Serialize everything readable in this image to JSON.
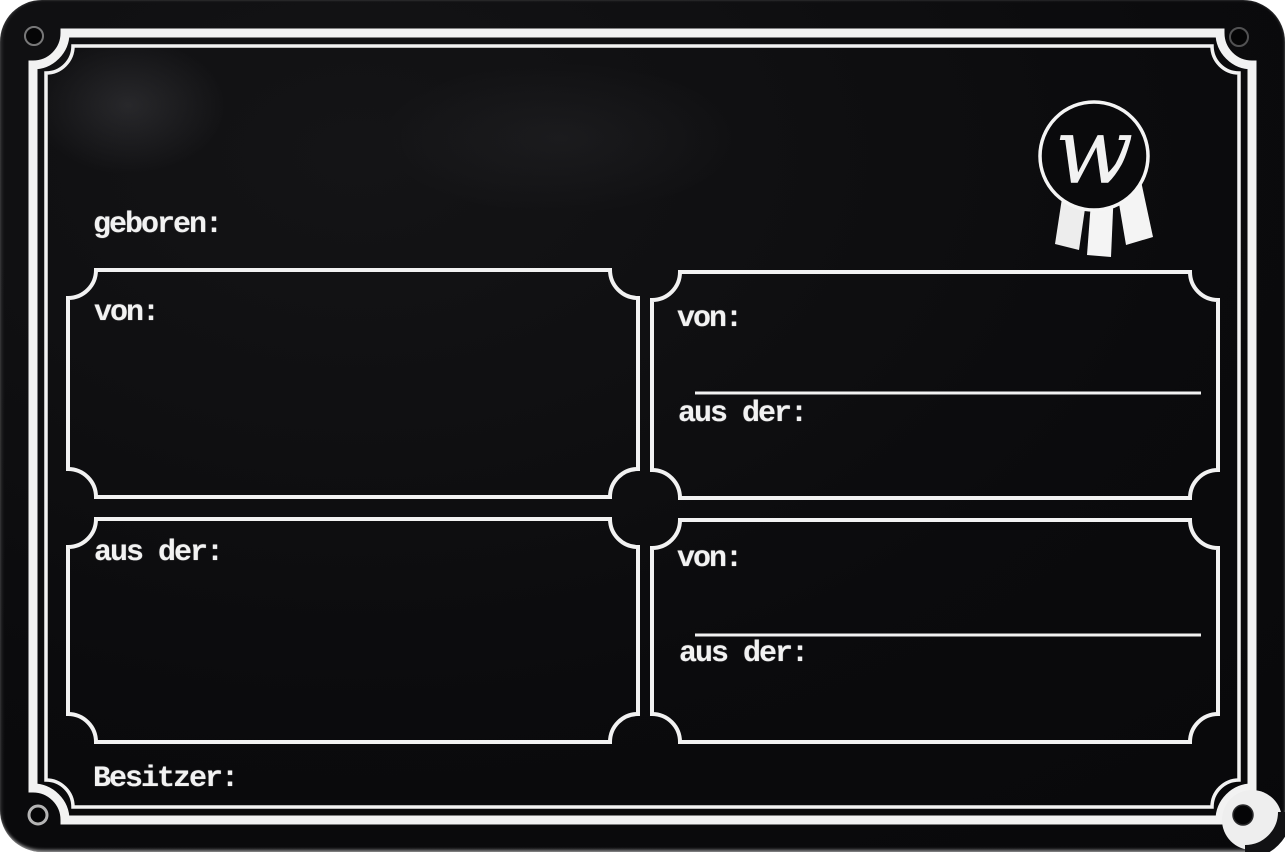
{
  "sign": {
    "born_label": "geboren:",
    "owner_label": "Besitzer:",
    "boxes": {
      "top_left": {
        "sire_label": "von:"
      },
      "top_right": {
        "sire_label": "von:",
        "dam_label": "aus der:"
      },
      "bottom_left": {
        "dam_label": "aus der:"
      },
      "bottom_right": {
        "sire_label": "von:",
        "dam_label": "aus der:"
      }
    },
    "logo": {
      "monogram": "w"
    }
  },
  "colors": {
    "plate_black": "#0b0b0d",
    "line_white": "#f2f2f2",
    "backdrop_white": "#ffffff"
  }
}
